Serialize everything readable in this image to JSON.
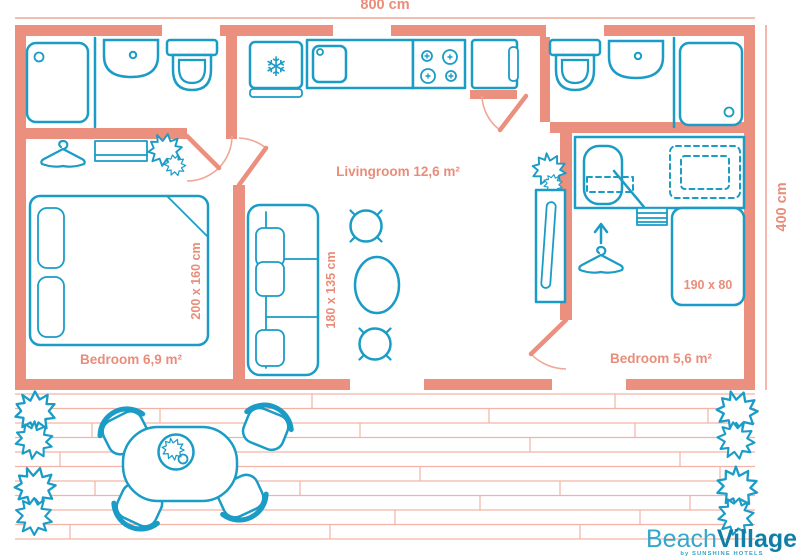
{
  "diagram": {
    "type": "floorplan",
    "dimensions": {
      "width_label": "800 cm",
      "height_label": "400 cm"
    },
    "rooms": {
      "livingroom": {
        "label": "Livingroom 12,6 m²"
      },
      "bedroom_left": {
        "label": "Bedroom 6,9 m²"
      },
      "bedroom_right": {
        "label": "Bedroom 5,6 m²"
      }
    },
    "furniture": {
      "bed_left_size": "200 x 160 cm",
      "sofa_size": "180 x 135 cm",
      "bed_right_size": "190 x 80"
    },
    "icons": {
      "snowflake": "❄"
    },
    "colors": {
      "wall": "#EB8F7E",
      "furniture_stroke": "#1B9CC6",
      "label_text": "#E98D7B",
      "deck_plank": "#F2B3A6",
      "logo_light": "#33A7CC",
      "logo_dark": "#0F7FA8"
    }
  },
  "branding": {
    "name_regular": "Beach",
    "name_bold": "Village",
    "tagline": "by SUNSHINE HOTELS"
  }
}
